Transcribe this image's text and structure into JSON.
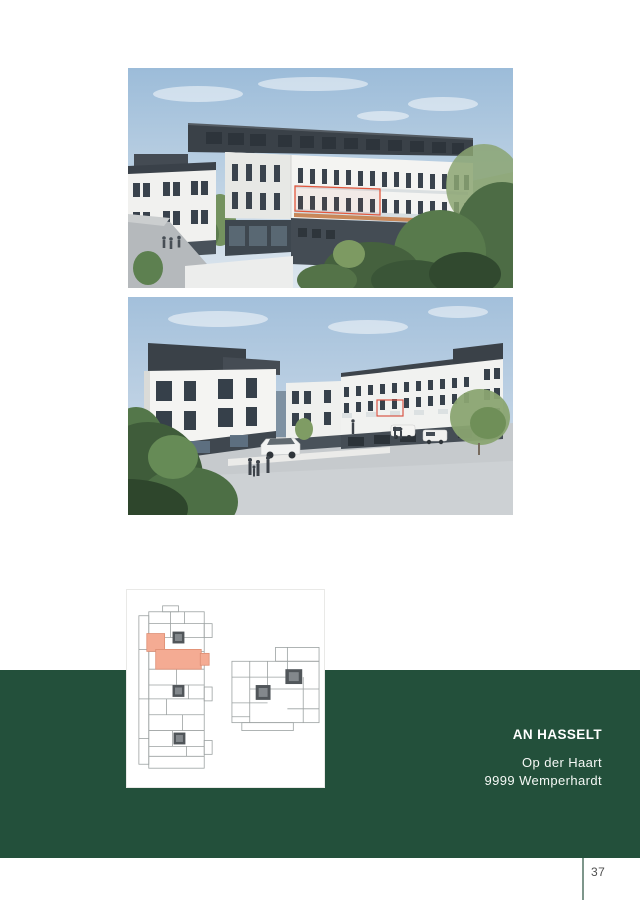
{
  "project": {
    "name": "AN HASSELT",
    "address_line1": "Op der Haart",
    "address_line2": "9999 Wemperhardt"
  },
  "footer": {
    "page_number": "37"
  },
  "colors": {
    "brand_green": "#23503B",
    "footer_rule": "#7E968B",
    "unit_highlight_fill": "#F4AB93",
    "unit_highlight_outline": "#DD5742",
    "rendering_highlight_outline": "#E2573D",
    "text_on_green": "#FFFFFF",
    "page_number_text": "#4F4F4F"
  },
  "images": {
    "photo_top": "exterior-rendering-rear-perspective-with-highlighted-unit",
    "photo_middle": "exterior-rendering-street-view-with-parking",
    "floor_plan": "floor-plans-two-buildings-with-highlighted-unit"
  }
}
